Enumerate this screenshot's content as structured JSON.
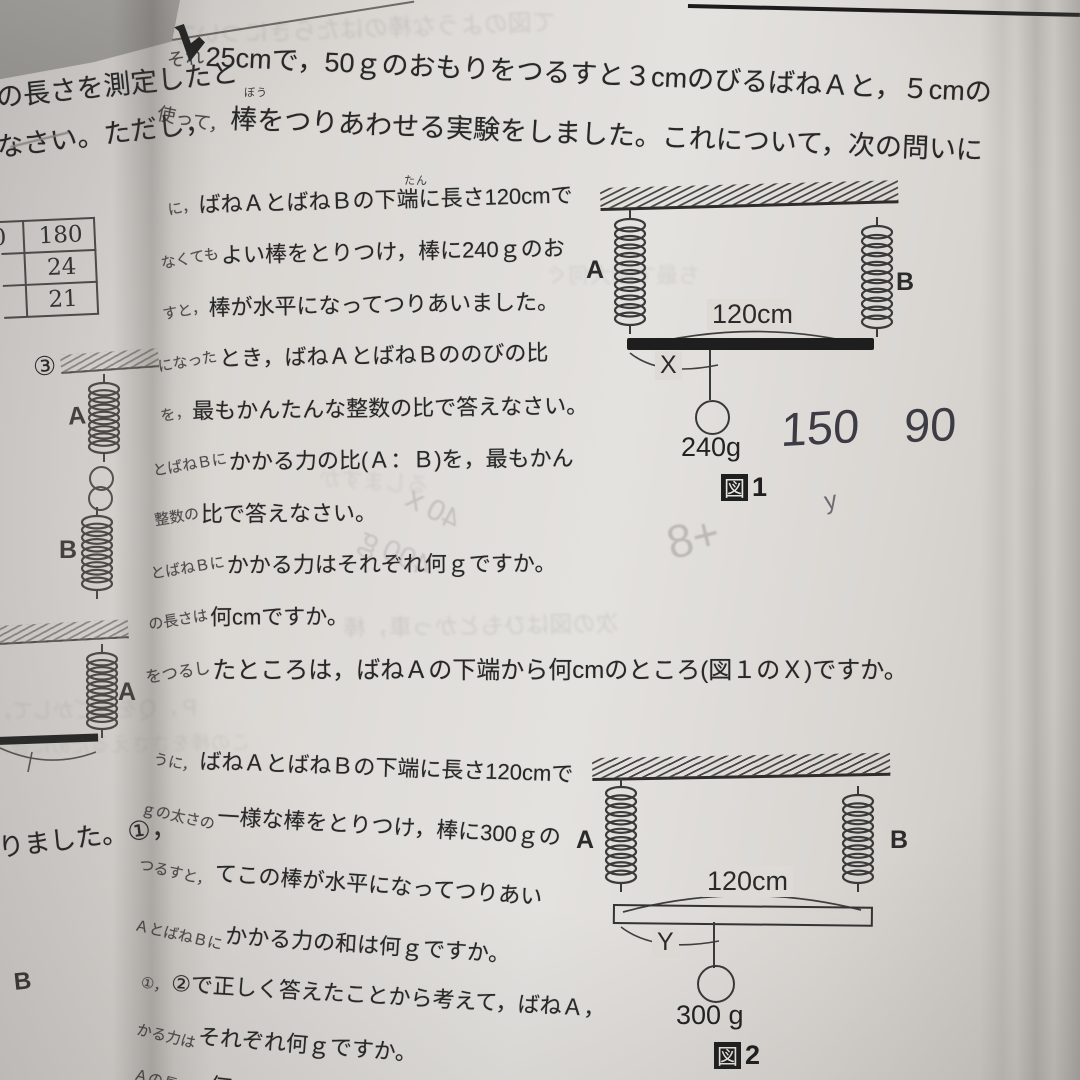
{
  "left_page": {
    "line1": "の長さを測定したと",
    "line2": "なさい。ただし，",
    "line3": "りました。①，",
    "stray_b": "B",
    "item3_marker": "③",
    "table": {
      "partial_left_cell": "0",
      "values": [
        "180",
        "24",
        "21"
      ]
    },
    "spring_labels": {
      "top_a": "A",
      "top_b": "B",
      "bottom_a": "A"
    }
  },
  "right_page": {
    "intro_lines": [
      {
        "frag": "それ",
        "main": "25cmで，50ｇのおもりをつるすと３cmのびるばねＡと，５cmの"
      },
      {
        "frag": "使って，",
        "main": "棒をつりあわせる実験をしました。これについて，次の問いに"
      }
    ],
    "furigana_bou": "ぼう",
    "furigana_tan": "たん",
    "q1_lines": [
      {
        "frag": "に，",
        "main": "ばねＡとばねＢの下端に長さ120cmで"
      },
      {
        "frag": "なくても",
        "main": "よい棒をとりつけ，棒に240ｇのお"
      },
      {
        "frag": "すと，",
        "main": "棒が水平になってつりあいました。"
      },
      {
        "frag": "になった",
        "main": "とき，ばねＡとばねＢののびの比"
      },
      {
        "frag": "を，",
        "main": "最もかんたんな整数の比で答えなさい。"
      },
      {
        "frag": "とばねＢに",
        "main": "かかる力の比(Ａ：Ｂ)を，最もかん"
      },
      {
        "frag": "整数の",
        "main": "比で答えなさい。"
      },
      {
        "frag": "とばねＢに",
        "main": "かかる力はそれぞれ何ｇですか。"
      },
      {
        "frag": "の長さは",
        "main": "何cmですか。"
      },
      {
        "frag": "をつるし",
        "main": "たところは，ばねＡの下端から何cmのところ(図１のＸ)ですか。"
      }
    ],
    "q2_lines": [
      {
        "frag": "うに，",
        "main": "ばねＡとばねＢの下端に長さ120cmで"
      },
      {
        "frag": "ｇの太さの",
        "main": "一様な棒をとりつけ，棒に300ｇの"
      },
      {
        "frag": "つるすと，",
        "main": "てこの棒が水平になってつりあい"
      },
      {
        "frag": "ＡとばねＢに",
        "main": "かかる力の和は何ｇですか。"
      },
      {
        "frag": "①，",
        "main": "②で正しく答えたことから考えて，ばねＡ，"
      },
      {
        "frag": "かる力は",
        "main": "それぞれ何ｇですか。"
      },
      {
        "frag": "Ａの長さは",
        "main": "何"
      }
    ],
    "fig1": {
      "spring_a": "A",
      "spring_b": "B",
      "length": "120cm",
      "hang_label": "X",
      "weight": "240g",
      "caption_fig": "図",
      "caption_num": "1"
    },
    "fig2": {
      "spring_a": "A",
      "spring_b": "B",
      "length": "120cm",
      "hang_label": "Y",
      "weight": "300 g",
      "caption_fig": "図",
      "caption_num": "2"
    },
    "handwriting": {
      "n1": "150",
      "n2": "90",
      "small_mark": "y"
    },
    "pencil_ghosts": [
      {
        "text": "+8"
      },
      {
        "text": "40ｘ"
      },
      {
        "text": "400ｇ"
      }
    ],
    "ghosts": [
      {
        "text": "て図のような棒のはたらきについて"
      },
      {
        "text": "ち最で回大何ぐ"
      },
      {
        "text": "るしますか"
      },
      {
        "text": "次の図はひもとかっ車，棒"
      },
      {
        "text": "Ｐ，Ｑをうごかして，はしにＱcmで棒が水平に"
      },
      {
        "text": "この棒をささえるために答えなさい"
      }
    ]
  }
}
